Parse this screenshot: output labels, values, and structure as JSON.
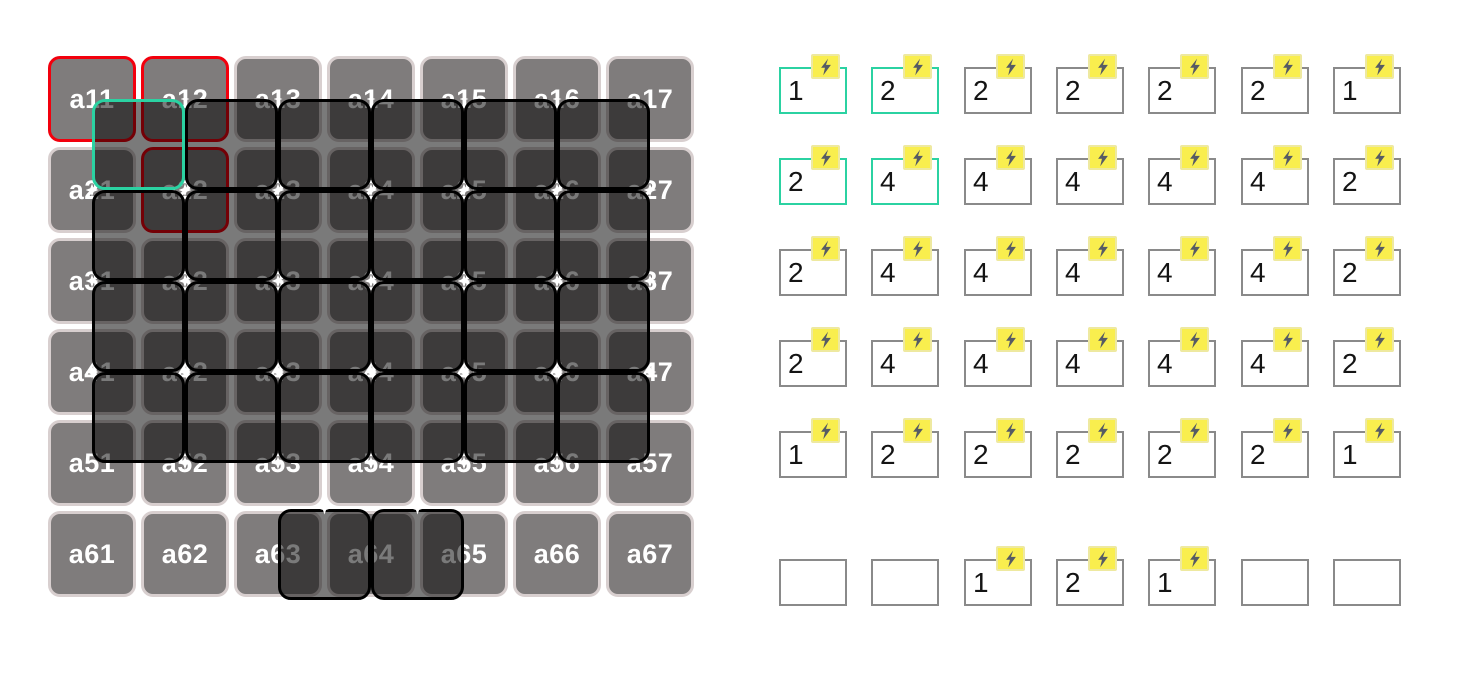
{
  "colors": {
    "teal_highlight": "#2bd2a2",
    "red_highlight": "#f2000d",
    "cell_gray": "#7f7c7c",
    "cell_border": "#d8cfcf",
    "overlay_black": "#000000",
    "badge_yellow": "#f9ee4e",
    "badge_border": "#eee9a0",
    "bolt_slate": "#565b64",
    "box_border_gray": "#8a8a8a",
    "sparkle_white": "#ffffff"
  },
  "left_grid": {
    "rows": 6,
    "cols": 7,
    "labels": [
      [
        "a11",
        "a12",
        "a13",
        "a14",
        "a15",
        "a16",
        "a17"
      ],
      [
        "a21",
        "a22",
        "a23",
        "a24",
        "a25",
        "a26",
        "a27"
      ],
      [
        "a31",
        "a32",
        "a33",
        "a34",
        "a35",
        "a36",
        "a37"
      ],
      [
        "a41",
        "a42",
        "a43",
        "a44",
        "a45",
        "a46",
        "a47"
      ],
      [
        "a51",
        "a52",
        "a53",
        "a54",
        "a55",
        "a56",
        "a57"
      ],
      [
        "a61",
        "a62",
        "a63",
        "a64",
        "a65",
        "a66",
        "a67"
      ]
    ],
    "red_outlined_cells": [
      "a11",
      "a12",
      "a22"
    ],
    "kernel_overlays": {
      "intersection_rows": 4,
      "intersection_cols": 6,
      "teal_at": [
        0,
        0
      ],
      "bottom_row_pairs": [
        [
          3,
          4
        ],
        [
          4,
          5
        ]
      ]
    }
  },
  "right_grid": {
    "rows": 6,
    "cols": 7,
    "values": [
      [
        1,
        2,
        2,
        2,
        2,
        2,
        1
      ],
      [
        2,
        4,
        4,
        4,
        4,
        4,
        2
      ],
      [
        2,
        4,
        4,
        4,
        4,
        4,
        2
      ],
      [
        2,
        4,
        4,
        4,
        4,
        4,
        2
      ],
      [
        1,
        2,
        2,
        2,
        2,
        2,
        1
      ],
      [
        null,
        null,
        1,
        2,
        1,
        null,
        null
      ]
    ],
    "teal_boxes": [
      [
        0,
        0
      ],
      [
        0,
        1
      ],
      [
        1,
        0
      ],
      [
        1,
        1
      ]
    ],
    "badge_icon": "lightning-bolt-icon"
  }
}
